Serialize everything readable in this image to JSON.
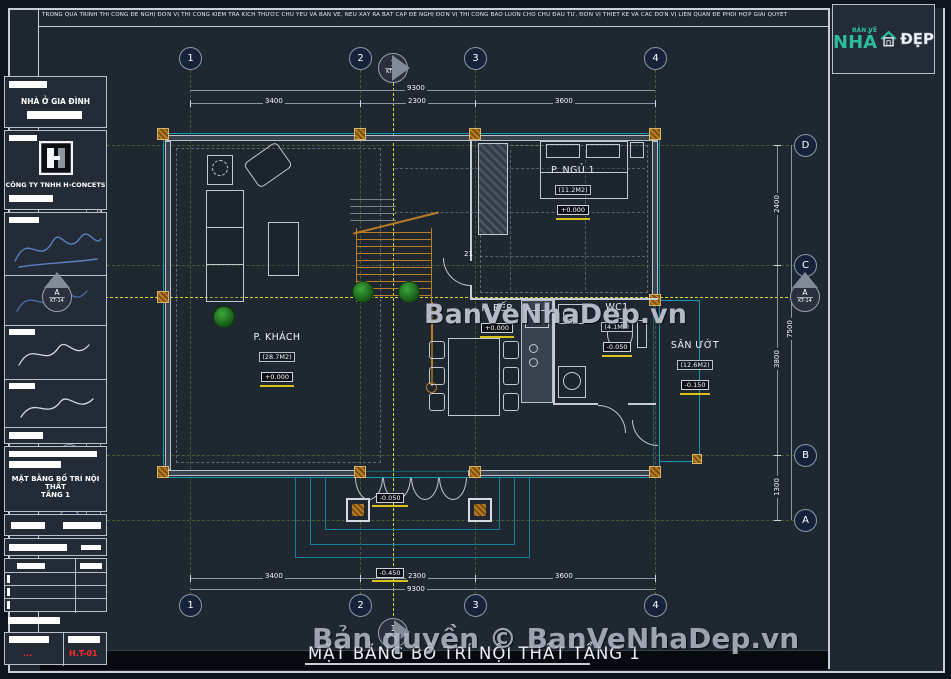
{
  "colors": {
    "wall_cyan": "#1596b4",
    "centerline_yellow": "#e6e62e",
    "wood_orange": "#b97d22",
    "logo_teal": "#2bbd9b",
    "sheet_red": "#ff2b2b",
    "watermark_gray": "#b3bac6"
  },
  "note": "TRONG QUÁ TRÌNH THI CÔNG ĐỀ NGHỊ ĐƠN VỊ THI CÔNG KIỂM TRA KÍCH THƯỚC CHỦ YẾU VÀ BẢN VẼ, NẾU XẢY RA BẤT CẬP ĐỀ NGHỊ ĐƠN VỊ THI CÔNG BÁO LUÔN CHO CHỦ ĐẦU TƯ, ĐƠN VỊ THIẾT KẾ VÀ CÁC ĐƠN VỊ LIÊN QUAN ĐỂ PHỐI HỢP GIẢI QUYẾT",
  "watermarks": {
    "center": "BanVeNhaDep.vn",
    "bottom": "Bản quyền © BanVeNhaDep.vn"
  },
  "drawing_title": "MẶT BẰNG BỐ TRÍ NỘI THẤT TẦNG 1",
  "grid": {
    "cols": [
      "1",
      "2",
      "3",
      "4"
    ],
    "rows": [
      "D",
      "C",
      "B",
      "A"
    ]
  },
  "markers": {
    "top": {
      "num": "1",
      "sheet": "KT-15"
    },
    "bottom": {
      "num": "1",
      "sheet": "KT-15"
    },
    "left": {
      "num": "A",
      "sheet": "KT-14"
    },
    "right": {
      "num": "A",
      "sheet": "KT-14"
    }
  },
  "rooms": [
    {
      "name": "P. KHÁCH",
      "area": "(28.7M2)",
      "level": "+0.000"
    },
    {
      "name": "P. NGỦ 1",
      "area": "(11.2M2)",
      "level": "+0.000"
    },
    {
      "name": "P. BẾP",
      "area": "",
      "level": "+0.000"
    },
    {
      "name": "WC1",
      "area": "(4.1M2)",
      "level": "-0.050"
    },
    {
      "name": "SÂN ƯỚT",
      "area": "(12.6M2)",
      "level": "-0.150"
    }
  ],
  "levels": {
    "porch": "-0.050",
    "step": "-0.450"
  },
  "stair_note": "21",
  "dimensions": {
    "top": {
      "overall": "9300",
      "segments": [
        "3400",
        "2300",
        "3600"
      ]
    },
    "bottom": {
      "overall": "9300",
      "segments": [
        "3400",
        "2300",
        "3600"
      ]
    },
    "left": {
      "overall": "7500",
      "segments": [
        "2400",
        "3800",
        "1300"
      ]
    },
    "right": {
      "overall": "7500",
      "segments": [
        "2400",
        "3800",
        "1300"
      ]
    }
  },
  "titleblock": {
    "logo": {
      "small": "BẢN VẼ",
      "big": "NHÀ",
      "right": "ĐẸP"
    },
    "project": "NHÀ Ở GIA ĐÌNH",
    "company": "CÔNG TY TNHH H-CONCETS",
    "title_line1": "MẶT BẰNG BỐ TRÍ NỘI THẤT",
    "title_line2": "TẦNG 1",
    "dots": "...",
    "sheet_no": "H.T-01"
  }
}
